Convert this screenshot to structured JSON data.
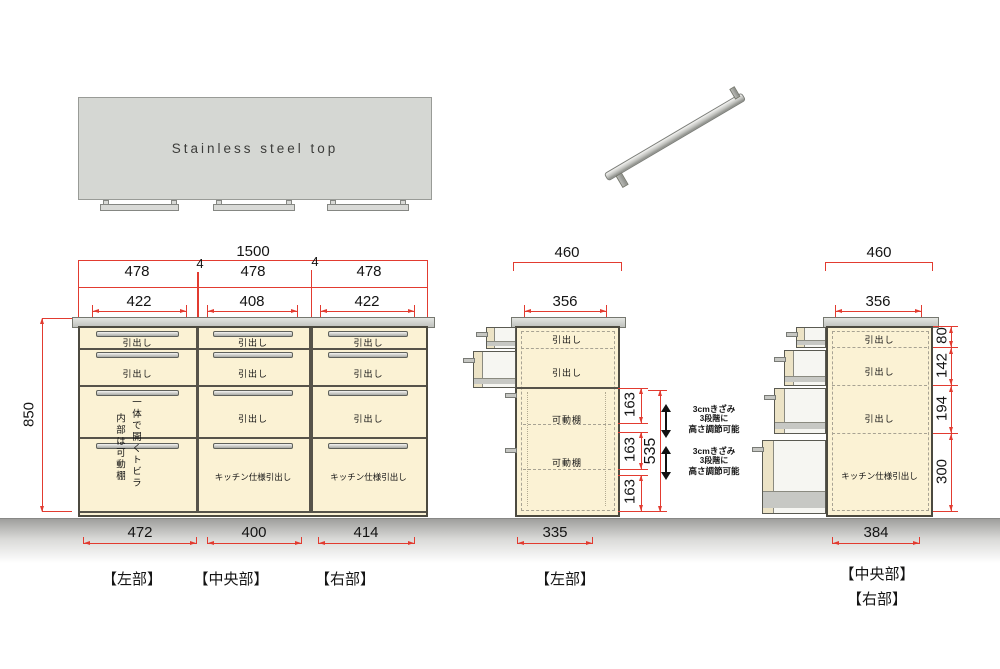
{
  "colors": {
    "red": "#e23b30",
    "cream": "#fbf2d4",
    "counter": "#c9cbc7",
    "outline": "#4c4a40",
    "panel": "#d5d7d3"
  },
  "top_panel": {
    "label": "Stainless steel top"
  },
  "labels": {
    "drawer": "引出し",
    "kitchen_drawer": "キッチン仕様引出し",
    "shelf": "可動棚",
    "door_line1": "一体で開くトビラ",
    "door_line2": "内部は可動棚"
  },
  "front": {
    "dim_total": "1500",
    "dim_gap": "4",
    "dim_cols": [
      "478",
      "478",
      "478"
    ],
    "dim_inner": [
      "422",
      "408",
      "422"
    ],
    "dim_height": "850",
    "dim_bottom": [
      "472",
      "400",
      "414"
    ],
    "sections": [
      "【左部】",
      "【中央部】",
      "【右部】"
    ]
  },
  "side_left": {
    "dim_top": "460",
    "dim_inner": "356",
    "dim_bottom": "335",
    "dim_segments": [
      "163",
      "163",
      "163"
    ],
    "dim_total": "535",
    "note": [
      "3cmきざみ",
      "3段階に",
      "高さ調節可能"
    ],
    "section": "【左部】"
  },
  "side_right": {
    "dim_top": "460",
    "dim_inner": "356",
    "dim_bottom": "384",
    "dim_segments": [
      "80",
      "142",
      "194",
      "300"
    ],
    "sections": [
      "【中央部】",
      "【右部】"
    ]
  }
}
